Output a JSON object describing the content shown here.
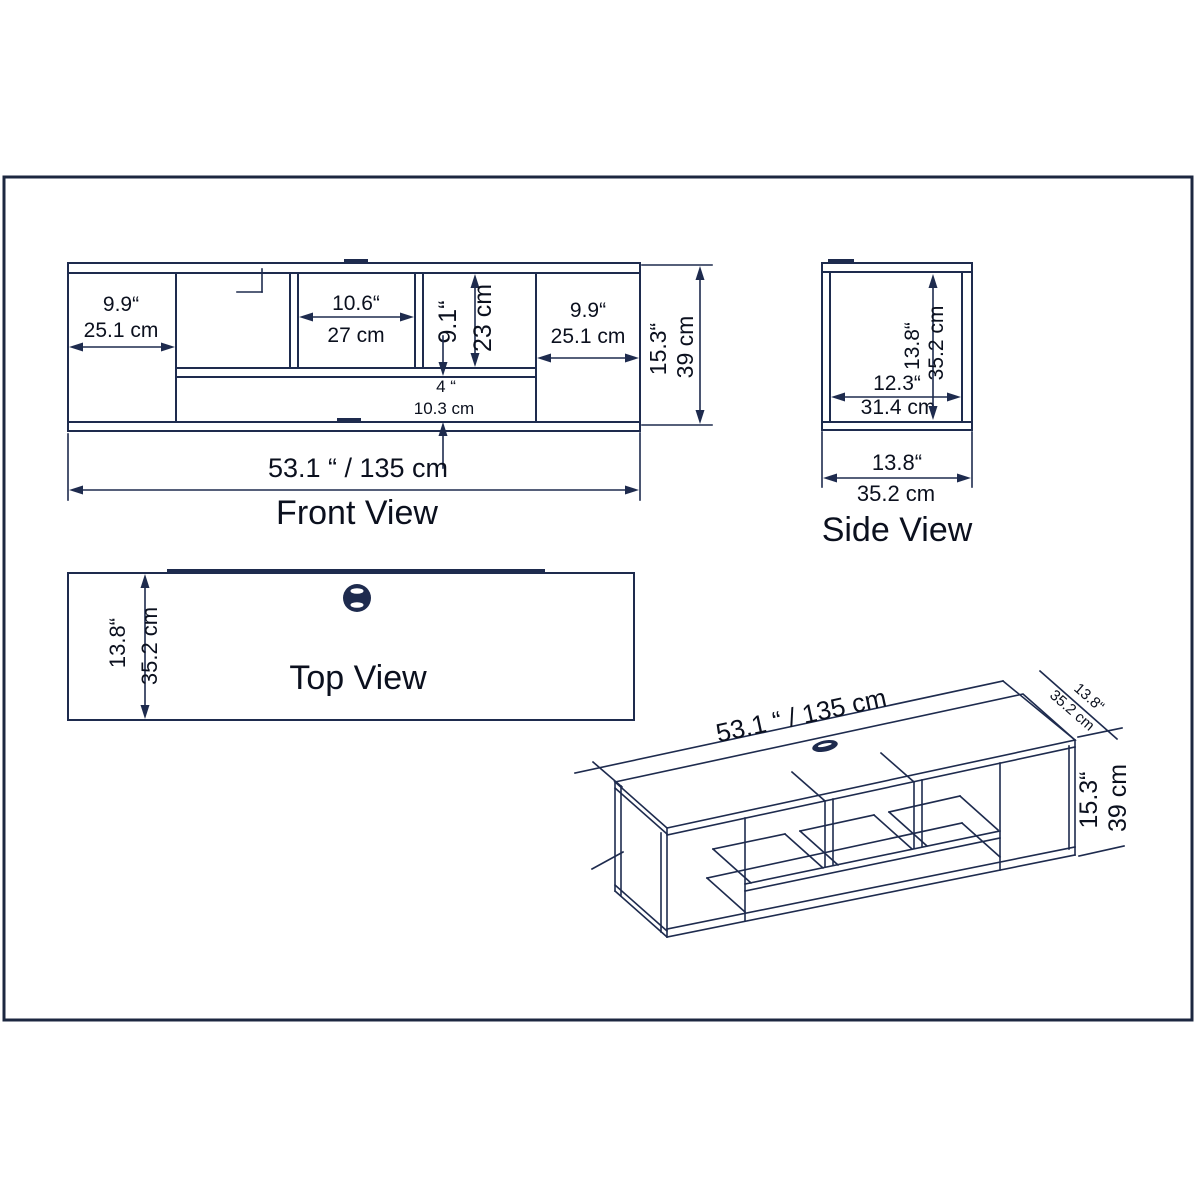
{
  "colors": {
    "line": "#1e2b4e",
    "text": "#0b101e",
    "background": "#ffffff"
  },
  "front": {
    "label": "Front View",
    "total_width": "53.1 “ / 135 cm",
    "height_in": "15.3“",
    "height_cm": "39 cm",
    "left_in": "9.9“",
    "left_cm": "25.1 cm",
    "middle_in": "10.6“",
    "middle_cm": "27 cm",
    "right_in": "9.9“",
    "right_cm": "25.1 cm",
    "opening_in": "9.1“",
    "opening_cm": "23 cm",
    "slot_in": "4 “",
    "slot_cm": "10.3 cm"
  },
  "side": {
    "label": "Side View",
    "inner_in": "12.3“",
    "inner_cm": "31.4 cm",
    "height_in": "13.8“",
    "height_cm": "35.2 cm",
    "depth_in": "13.8“",
    "depth_cm": "35.2  cm"
  },
  "top": {
    "label": "Top View",
    "depth_in": "13.8“",
    "depth_cm": "35.2 cm"
  },
  "iso": {
    "total_width": "53.1 “ / 135 cm",
    "depth_in": "13.8“",
    "depth_cm": "35.2 cm",
    "height_in": "15.3“",
    "height_cm": "39 cm"
  }
}
